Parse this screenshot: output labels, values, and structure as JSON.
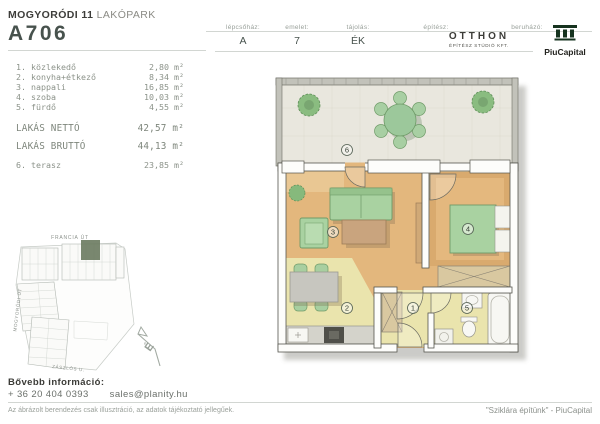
{
  "header": {
    "project_bold": "MOGYORÓDI 11",
    "project_light": "LAKÓPARK",
    "unit_id": "A706",
    "staircase_label": "lépcsőház:",
    "staircase_value": "A",
    "floor_label": "emelet:",
    "floor_value": "7",
    "orientation_label": "tájolás:",
    "orientation_value": "ÉK",
    "architect_label": "építész:",
    "architect_name": "OTTHON",
    "architect_sub": "ÉPÍTÉSZ STÚDIÓ KFT.",
    "developer_label": "beruházó:",
    "developer_name": "PiuCapital"
  },
  "room_list": {
    "rows": [
      {
        "num": "1.",
        "name": "közlekedő",
        "area": "2,80",
        "unit": "m²"
      },
      {
        "num": "2.",
        "name": "konyha+étkező",
        "area": "8,34",
        "unit": "m²"
      },
      {
        "num": "3.",
        "name": "nappali",
        "area": "16,85",
        "unit": "m²"
      },
      {
        "num": "4.",
        "name": "szoba",
        "area": "10,03",
        "unit": "m²"
      },
      {
        "num": "5.",
        "name": "fürdő",
        "area": "4,55",
        "unit": "m²"
      }
    ],
    "net_label": "LAKÁS NETTÓ",
    "net_area": "42,57",
    "net_unit": "m²",
    "gross_label": "LAKÁS BRUTTÓ",
    "gross_area": "44,13",
    "gross_unit": "m²",
    "terrace_num": "6.",
    "terrace_name": "terasz",
    "terrace_area": "23,85",
    "terrace_unit": "m²"
  },
  "site_plan": {
    "street_top": "FRANCIA ÚT",
    "street_left": "MOGYORÓDI ÚT",
    "street_bottom": "ZÁSZLÓS U.",
    "north_letter": "É",
    "highlight_color": "#6e7d63"
  },
  "floor_plan": {
    "terrace_num": "6",
    "living_num": "3",
    "bedroom_num": "4",
    "kitchen_num": "2",
    "hall_num": "1",
    "bath_num": "5",
    "furniture_green": "#a9d2a1",
    "floor_wood": "#e3b77d",
    "floor_tile": "#eae4ad"
  },
  "footer": {
    "info_label": "Bővebb információ:",
    "phone": "+ 36 20 404 0393",
    "email": "sales@planity.hu",
    "disclaimer": "Az ábrázolt berendezés csak illusztráció, az adatok tájékoztató jellegűek.",
    "slogan": "\"Sziklára építünk\" - PiuCapital",
    "logo_green": "#16331f"
  }
}
